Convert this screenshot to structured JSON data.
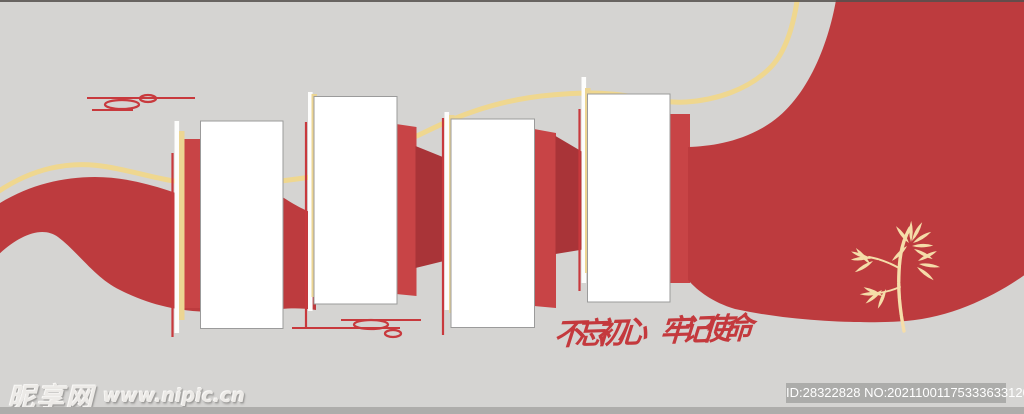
{
  "colors": {
    "background": "#d5d4d2",
    "ribbon_red": "#bd3b3e",
    "ribbon_bright": "#c84446",
    "ribbon_dark": "#a93438",
    "line_red": "#c8393d",
    "cloud_red": "#c8393d",
    "gold_line": "#efd78f",
    "gold_stripe": "#ecd593",
    "stripe_white": "#fdfdfc",
    "panel_white": "#ffffff",
    "panel_border": "#9b9b9b",
    "bamboo_gold": "#f5dda9",
    "slogan_red": "#c4393d",
    "watermark_text": "#eceae7",
    "badge_bg": "#acacaa",
    "badge_text": "#ffffff",
    "footer_strip": "#aeadab",
    "top_border": "#55504d"
  },
  "artwork": {
    "slogan": {
      "part1": "不忘初心",
      "part2": "牢记使命"
    },
    "boards": {
      "count": 4,
      "content": ""
    },
    "icons": [
      "cloud-motif-icon",
      "cloud-motif-icon",
      "bamboo-icon"
    ]
  },
  "watermark": {
    "site_name": "昵享网",
    "site_url": "www.nipic.cn"
  },
  "footer": {
    "badge_text": "ID:28322828 NO:20211001175333633120"
  }
}
